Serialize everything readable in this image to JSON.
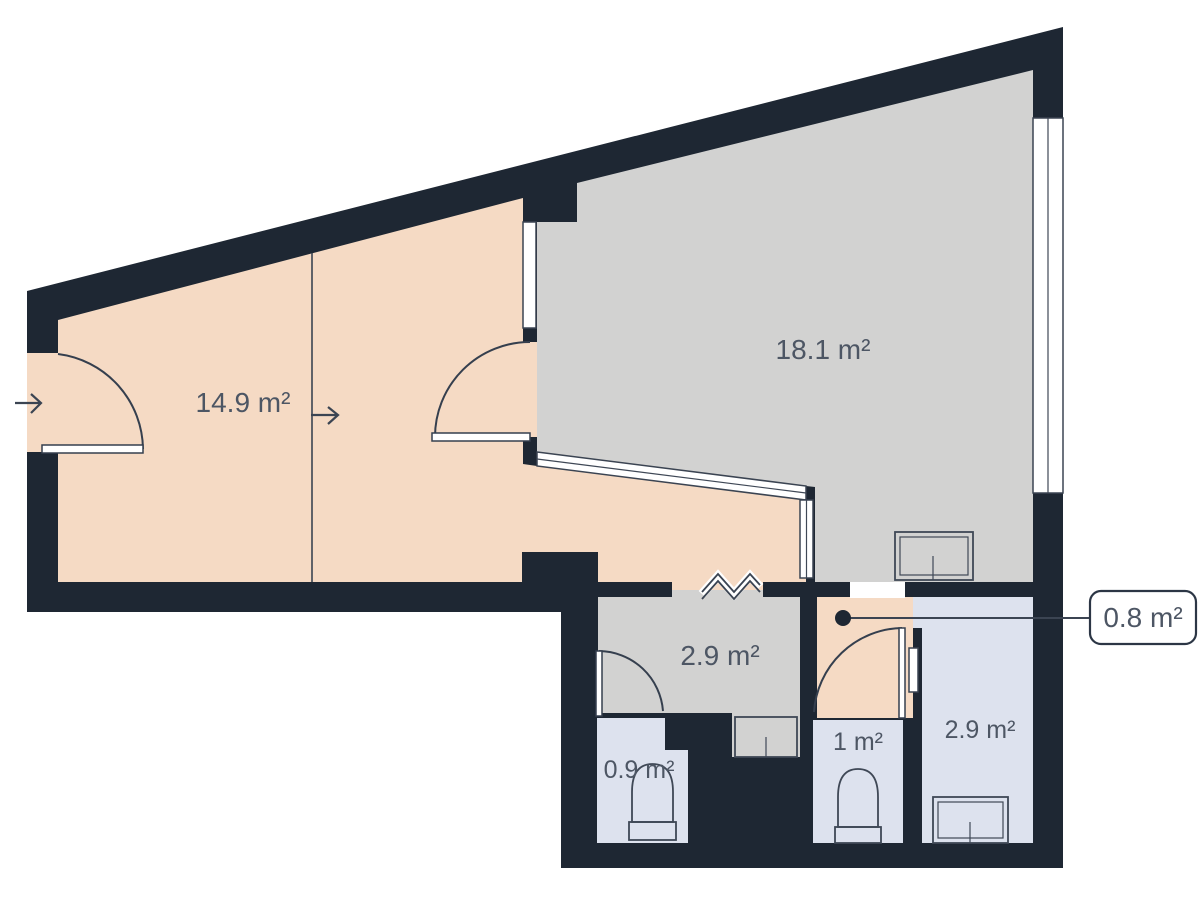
{
  "plan": {
    "type": "apartment-floor-plan",
    "rooms": {
      "bedroom": {
        "area_label": "14.9 m²"
      },
      "living_room": {
        "area_label": "18.1 m²"
      },
      "hallway": {
        "area_label": "2.9 m²"
      },
      "wc_small": {
        "area_label": "0.9 m²"
      },
      "wc": {
        "area_label": "1 m²"
      },
      "bathroom": {
        "area_label": "2.9 m²"
      },
      "vestibule": {
        "area_label": "0.8 m²"
      }
    },
    "callout": {
      "label": "0.8 m²"
    },
    "colors": {
      "walls": "#1e2733",
      "bedroom_floor": "#f5dac4",
      "living_floor": "#d2d2d1",
      "hallway_floor": "#d2d2d1",
      "bath_floor": "#dde2ee",
      "window_fill": "#ffffff",
      "outline": "#3b4452",
      "label_text": "#4d5664",
      "fixture_fill": "#eef1f8",
      "background": "#ffffff"
    }
  }
}
